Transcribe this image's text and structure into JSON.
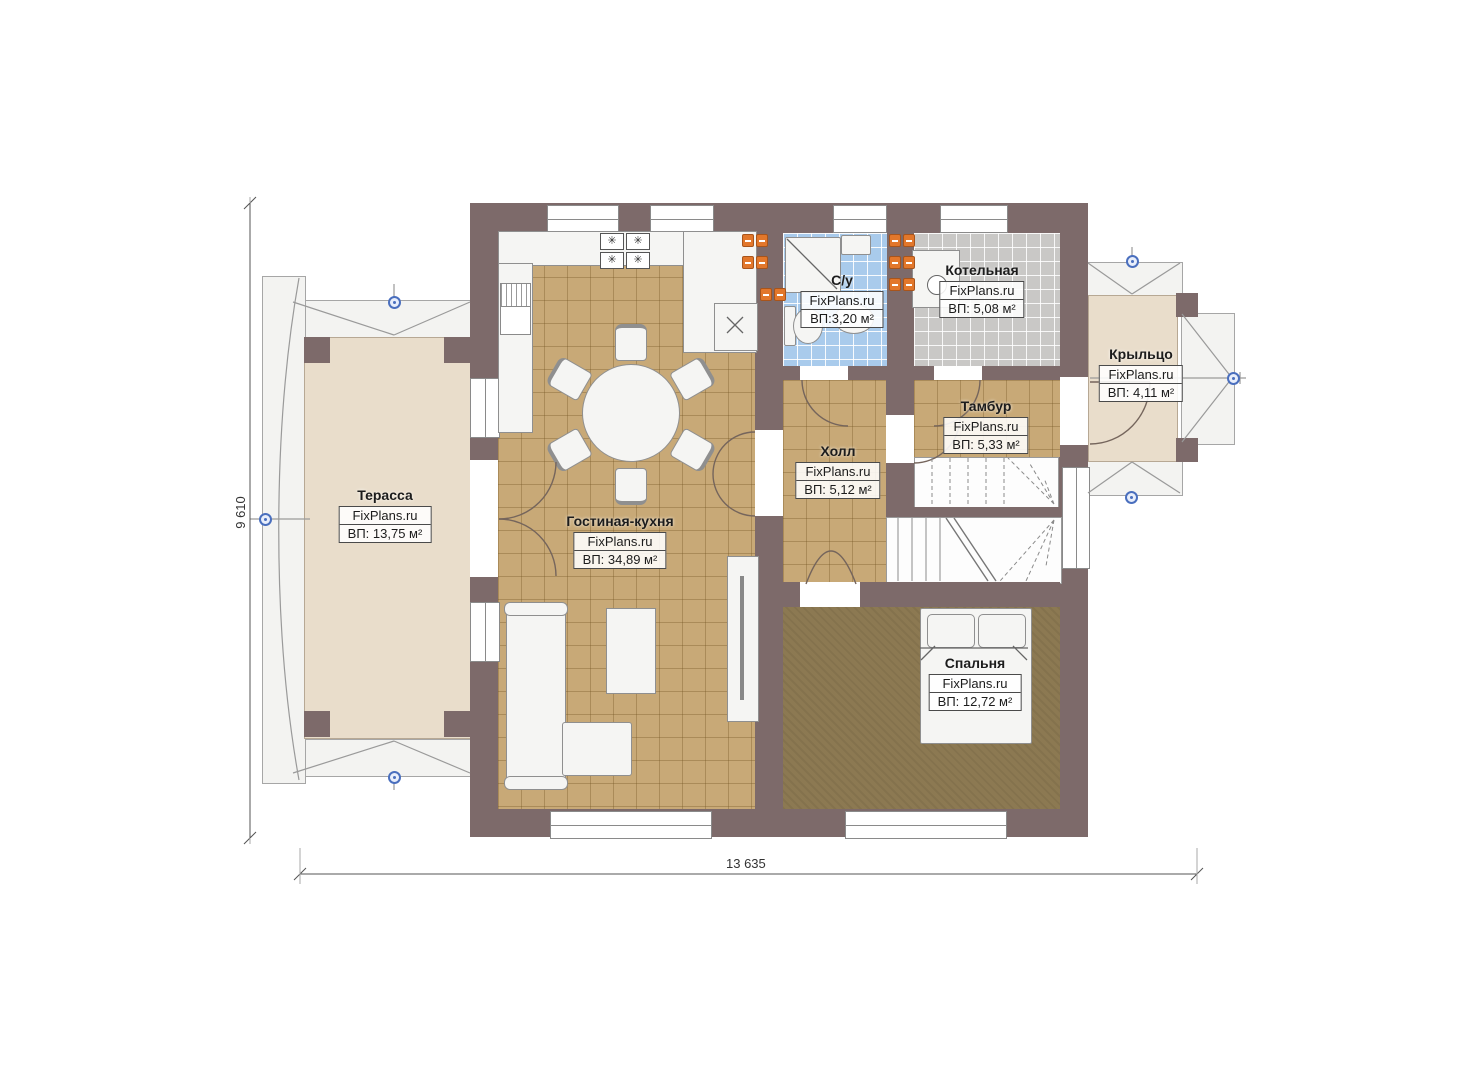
{
  "brand": "FixPlans.ru",
  "dimensions": {
    "horizontal": "13 635",
    "vertical": "9 610"
  },
  "icons": {
    "burner": "✳",
    "cross": "✕"
  },
  "rooms": [
    {
      "id": "terrace",
      "name": "Терасса",
      "brand": "FixPlans.ru",
      "area": "ВП: 13,75 м²"
    },
    {
      "id": "living",
      "name": "Гостиная-кухня",
      "brand": "FixPlans.ru",
      "area": "ВП: 34,89 м²"
    },
    {
      "id": "bathroom",
      "name": "С/у",
      "brand": "FixPlans.ru",
      "area": "ВП:3,20 м²"
    },
    {
      "id": "boiler",
      "name": "Котельная",
      "brand": "FixPlans.ru",
      "area": "ВП: 5,08 м²"
    },
    {
      "id": "porch",
      "name": "Крыльцо",
      "brand": "FixPlans.ru",
      "area": "ВП: 4,11 м²"
    },
    {
      "id": "vestibule",
      "name": "Тамбур",
      "brand": "FixPlans.ru",
      "area": "ВП: 5,33 м²"
    },
    {
      "id": "hall",
      "name": "Холл",
      "brand": "FixPlans.ru",
      "area": "ВП: 5,12 м²"
    },
    {
      "id": "bedroom",
      "name": "Спальня",
      "brand": "FixPlans.ru",
      "area": "ВП: 12,72 м²"
    }
  ],
  "colors": {
    "wall": "#7d6a6a",
    "tile_tan": "#c8a977",
    "tile_blue": "#a9cbec",
    "tile_gray": "#c9c8c6",
    "floor_bedroom": "#8c7952",
    "floor_terrace": "#e9ddcb",
    "socket_orange": "#e2772b",
    "marker_blue": "#4a6fbe"
  }
}
